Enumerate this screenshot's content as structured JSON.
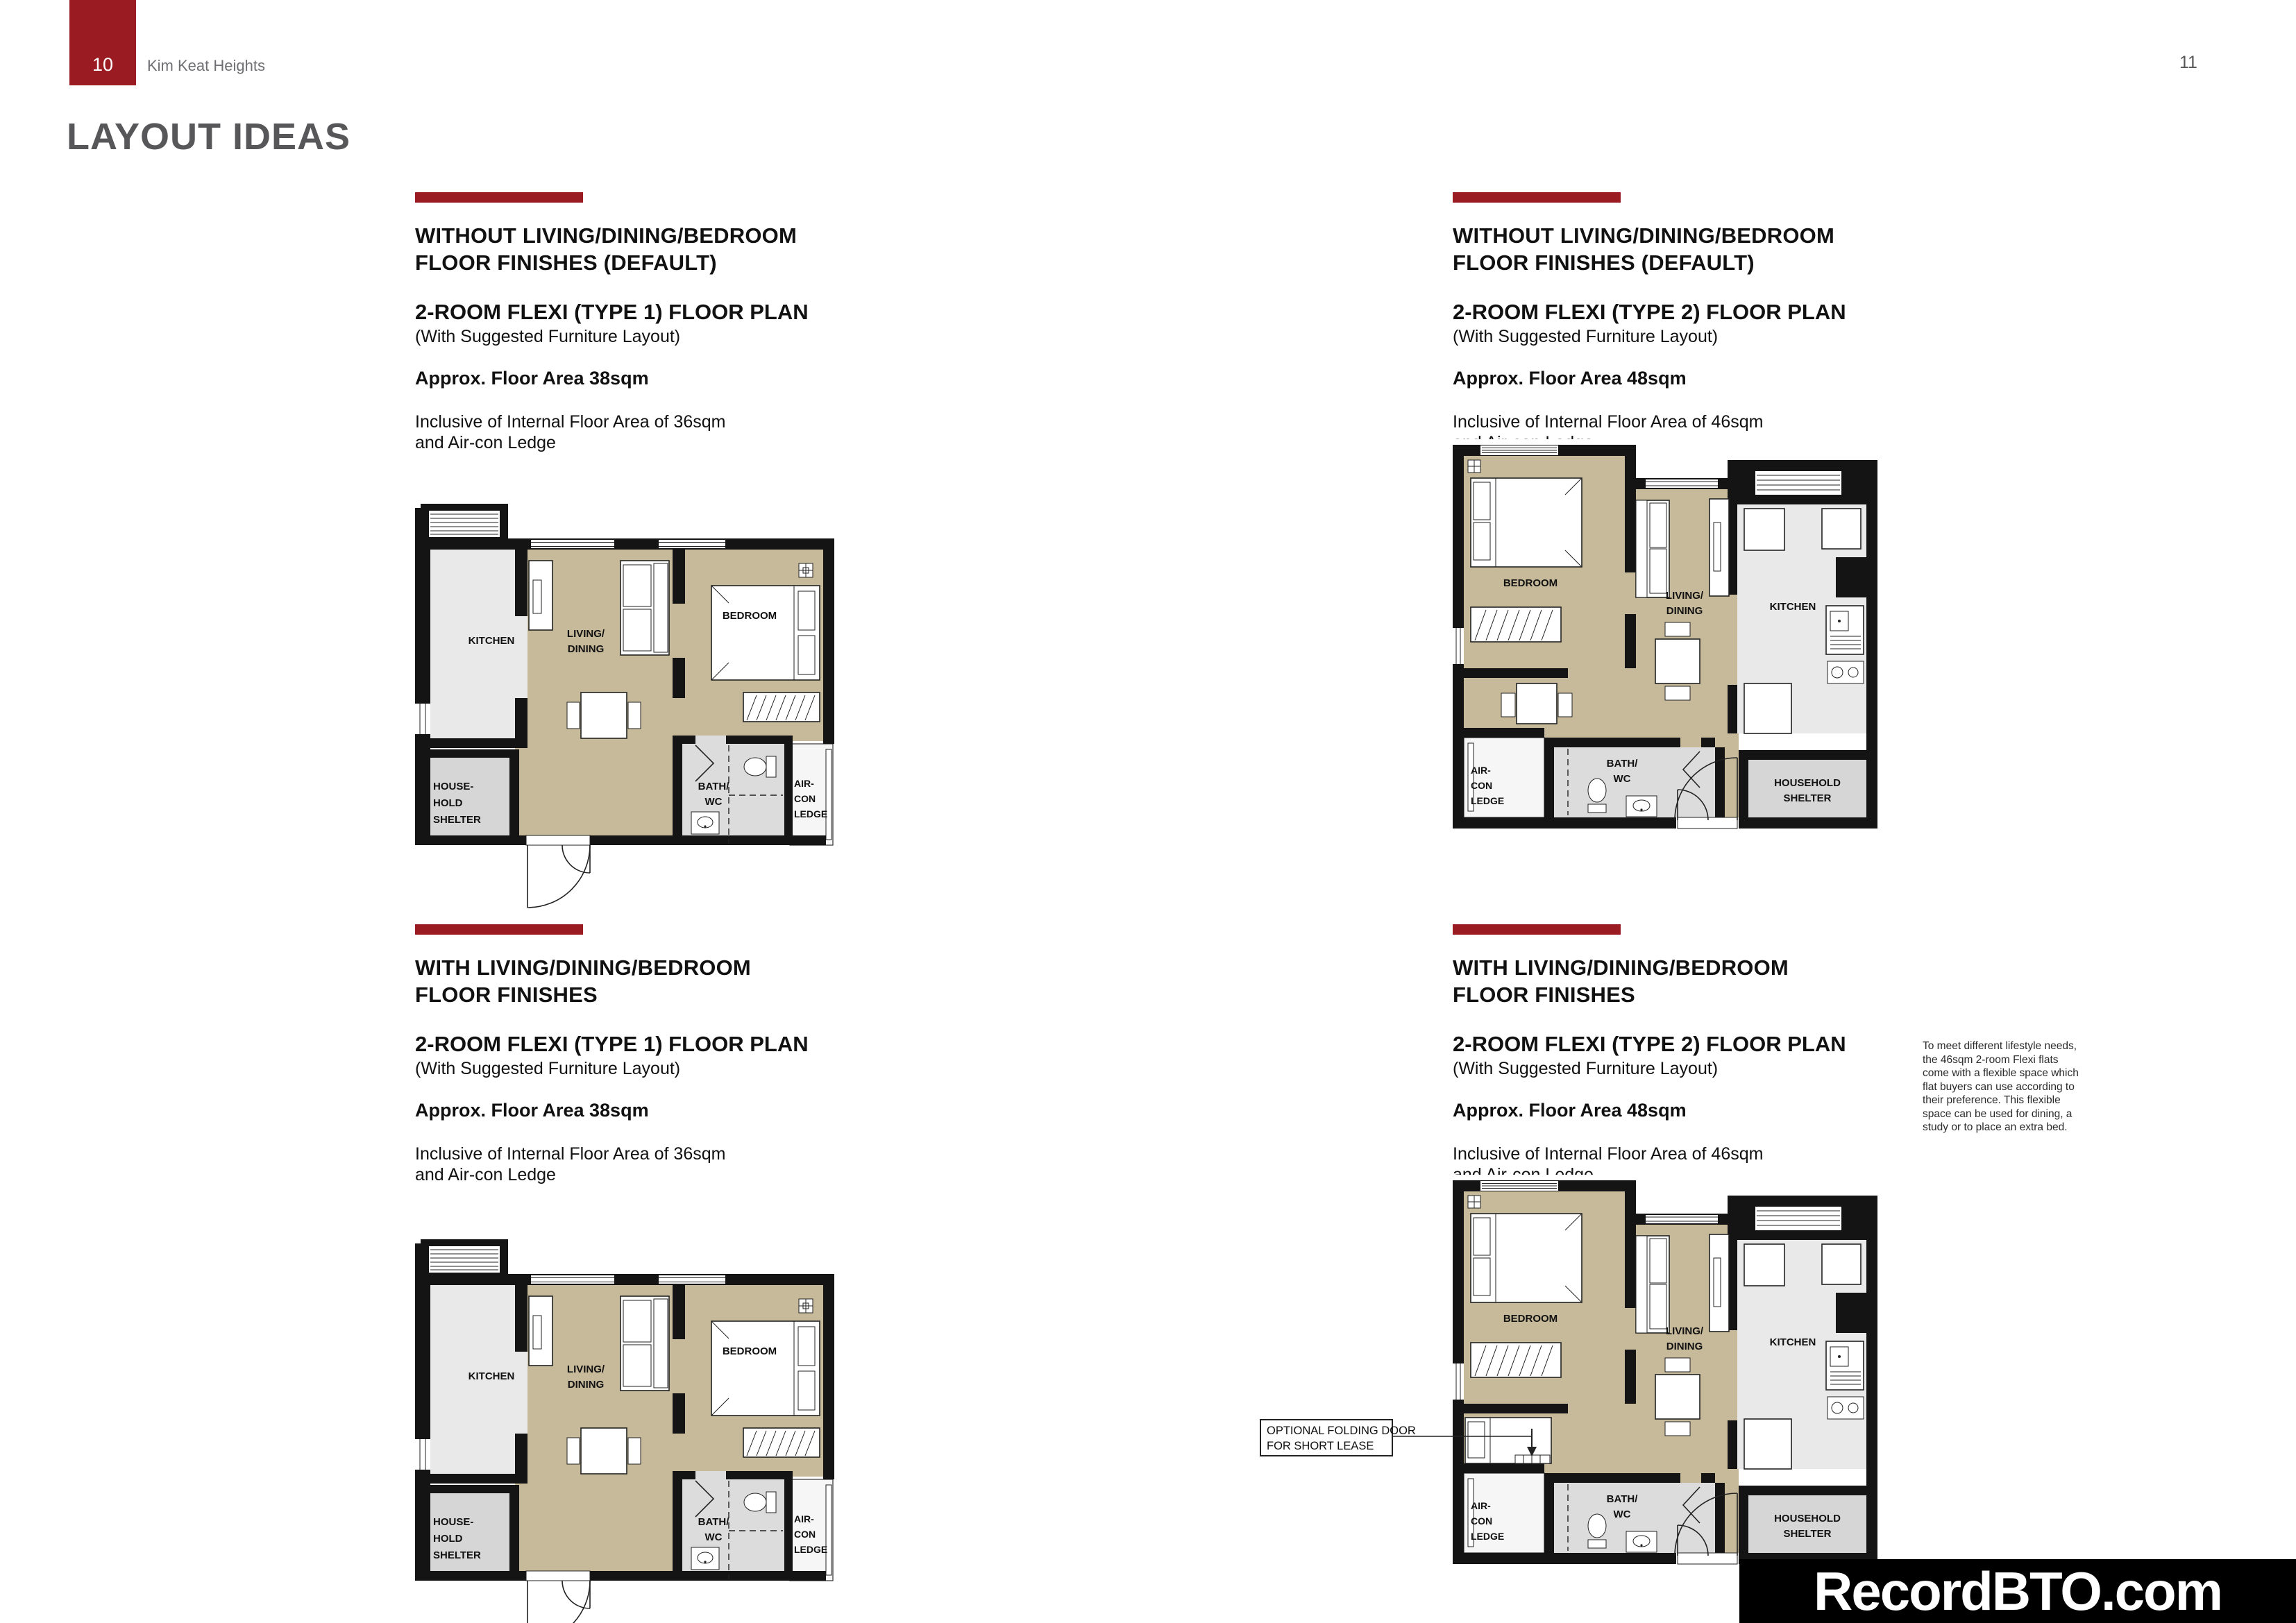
{
  "page": {
    "left_number": "10",
    "right_number": "11",
    "project": "Kim Keat Heights",
    "title": "LAYOUT IDEAS",
    "watermark": "RecordBTO.com"
  },
  "panels": [
    {
      "finish_line1": "WITHOUT LIVING/DINING/BEDROOM",
      "finish_line2": "FLOOR FINISHES (DEFAULT)",
      "plan_heading": "2-ROOM FLEXI (TYPE 1) FLOOR PLAN",
      "plan_subheading": "(With Suggested Furniture Layout)",
      "area_heading": "Approx. Floor Area 38sqm",
      "note_line1": "Inclusive of Internal Floor Area of 36sqm",
      "note_line2": "and Air-con Ledge"
    },
    {
      "finish_line1": "WITHOUT LIVING/DINING/BEDROOM",
      "finish_line2": "FLOOR FINISHES (DEFAULT)",
      "plan_heading": "2-ROOM FLEXI (TYPE 2) FLOOR PLAN",
      "plan_subheading": "(With Suggested Furniture Layout)",
      "area_heading": "Approx. Floor Area 48sqm",
      "note_line1": "Inclusive of Internal Floor Area of 46sqm",
      "note_line2": "and Air-con Ledge"
    },
    {
      "finish_line1": "WITH LIVING/DINING/BEDROOM",
      "finish_line2": "FLOOR FINISHES",
      "plan_heading": "2-ROOM FLEXI (TYPE 1) FLOOR PLAN",
      "plan_subheading": "(With Suggested Furniture Layout)",
      "area_heading": "Approx. Floor Area 38sqm",
      "note_line1": "Inclusive of Internal Floor Area of 36sqm",
      "note_line2": "and Air-con Ledge"
    },
    {
      "finish_line1": "WITH LIVING/DINING/BEDROOM",
      "finish_line2": "FLOOR FINISHES",
      "plan_heading": "2-ROOM FLEXI (TYPE 2) FLOOR PLAN",
      "plan_subheading": "(With Suggested Furniture Layout)",
      "area_heading": "Approx. Floor Area 48sqm",
      "note_line1": "Inclusive of Internal Floor Area of 46sqm",
      "note_line2": "and Air-con Ledge"
    }
  ],
  "plan_labels": {
    "type1": {
      "kitchen": "KITCHEN",
      "living1": "LIVING/",
      "living2": "DINING",
      "bedroom": "BEDROOM",
      "hh1": "HOUSE-",
      "hh2": "HOLD",
      "hh3": "SHELTER",
      "bath1": "BATH/",
      "bath2": "WC",
      "ac1": "AIR-",
      "ac2": "CON",
      "ac3": "LEDGE"
    },
    "type2": {
      "bedroom": "BEDROOM",
      "living1": "LIVING/",
      "living2": "DINING",
      "kitchen": "KITCHEN",
      "hh1": "HOUSEHOLD",
      "hh2": "SHELTER",
      "bath1": "BATH/",
      "bath2": "WC",
      "ac1": "AIR-",
      "ac2": "CON",
      "ac3": "LEDGE"
    }
  },
  "annotation": {
    "line1": "OPTIONAL FOLDING DOOR",
    "line2": "FOR SHORT LEASE"
  },
  "side_note": {
    "line1": "To meet different lifestyle needs,",
    "line2": "the 46sqm 2-room Flexi flats",
    "line3": "come with a flexible space which",
    "line4": "flat buyers can use according to",
    "line5": "their preference. This flexible",
    "line6": "space can be used for dining, a",
    "line7": "study or to place an extra bed."
  },
  "colors": {
    "maroon": "#9B1B23",
    "floor_beige": "#C7BA9B",
    "kitchen_gray": "#E9E9E9",
    "bath_gray": "#DCDCDC",
    "shelter_gray": "#D6D6D6",
    "wall_black": "#141414",
    "title_gray": "#57575A",
    "text_gray": "#6E6F72"
  }
}
